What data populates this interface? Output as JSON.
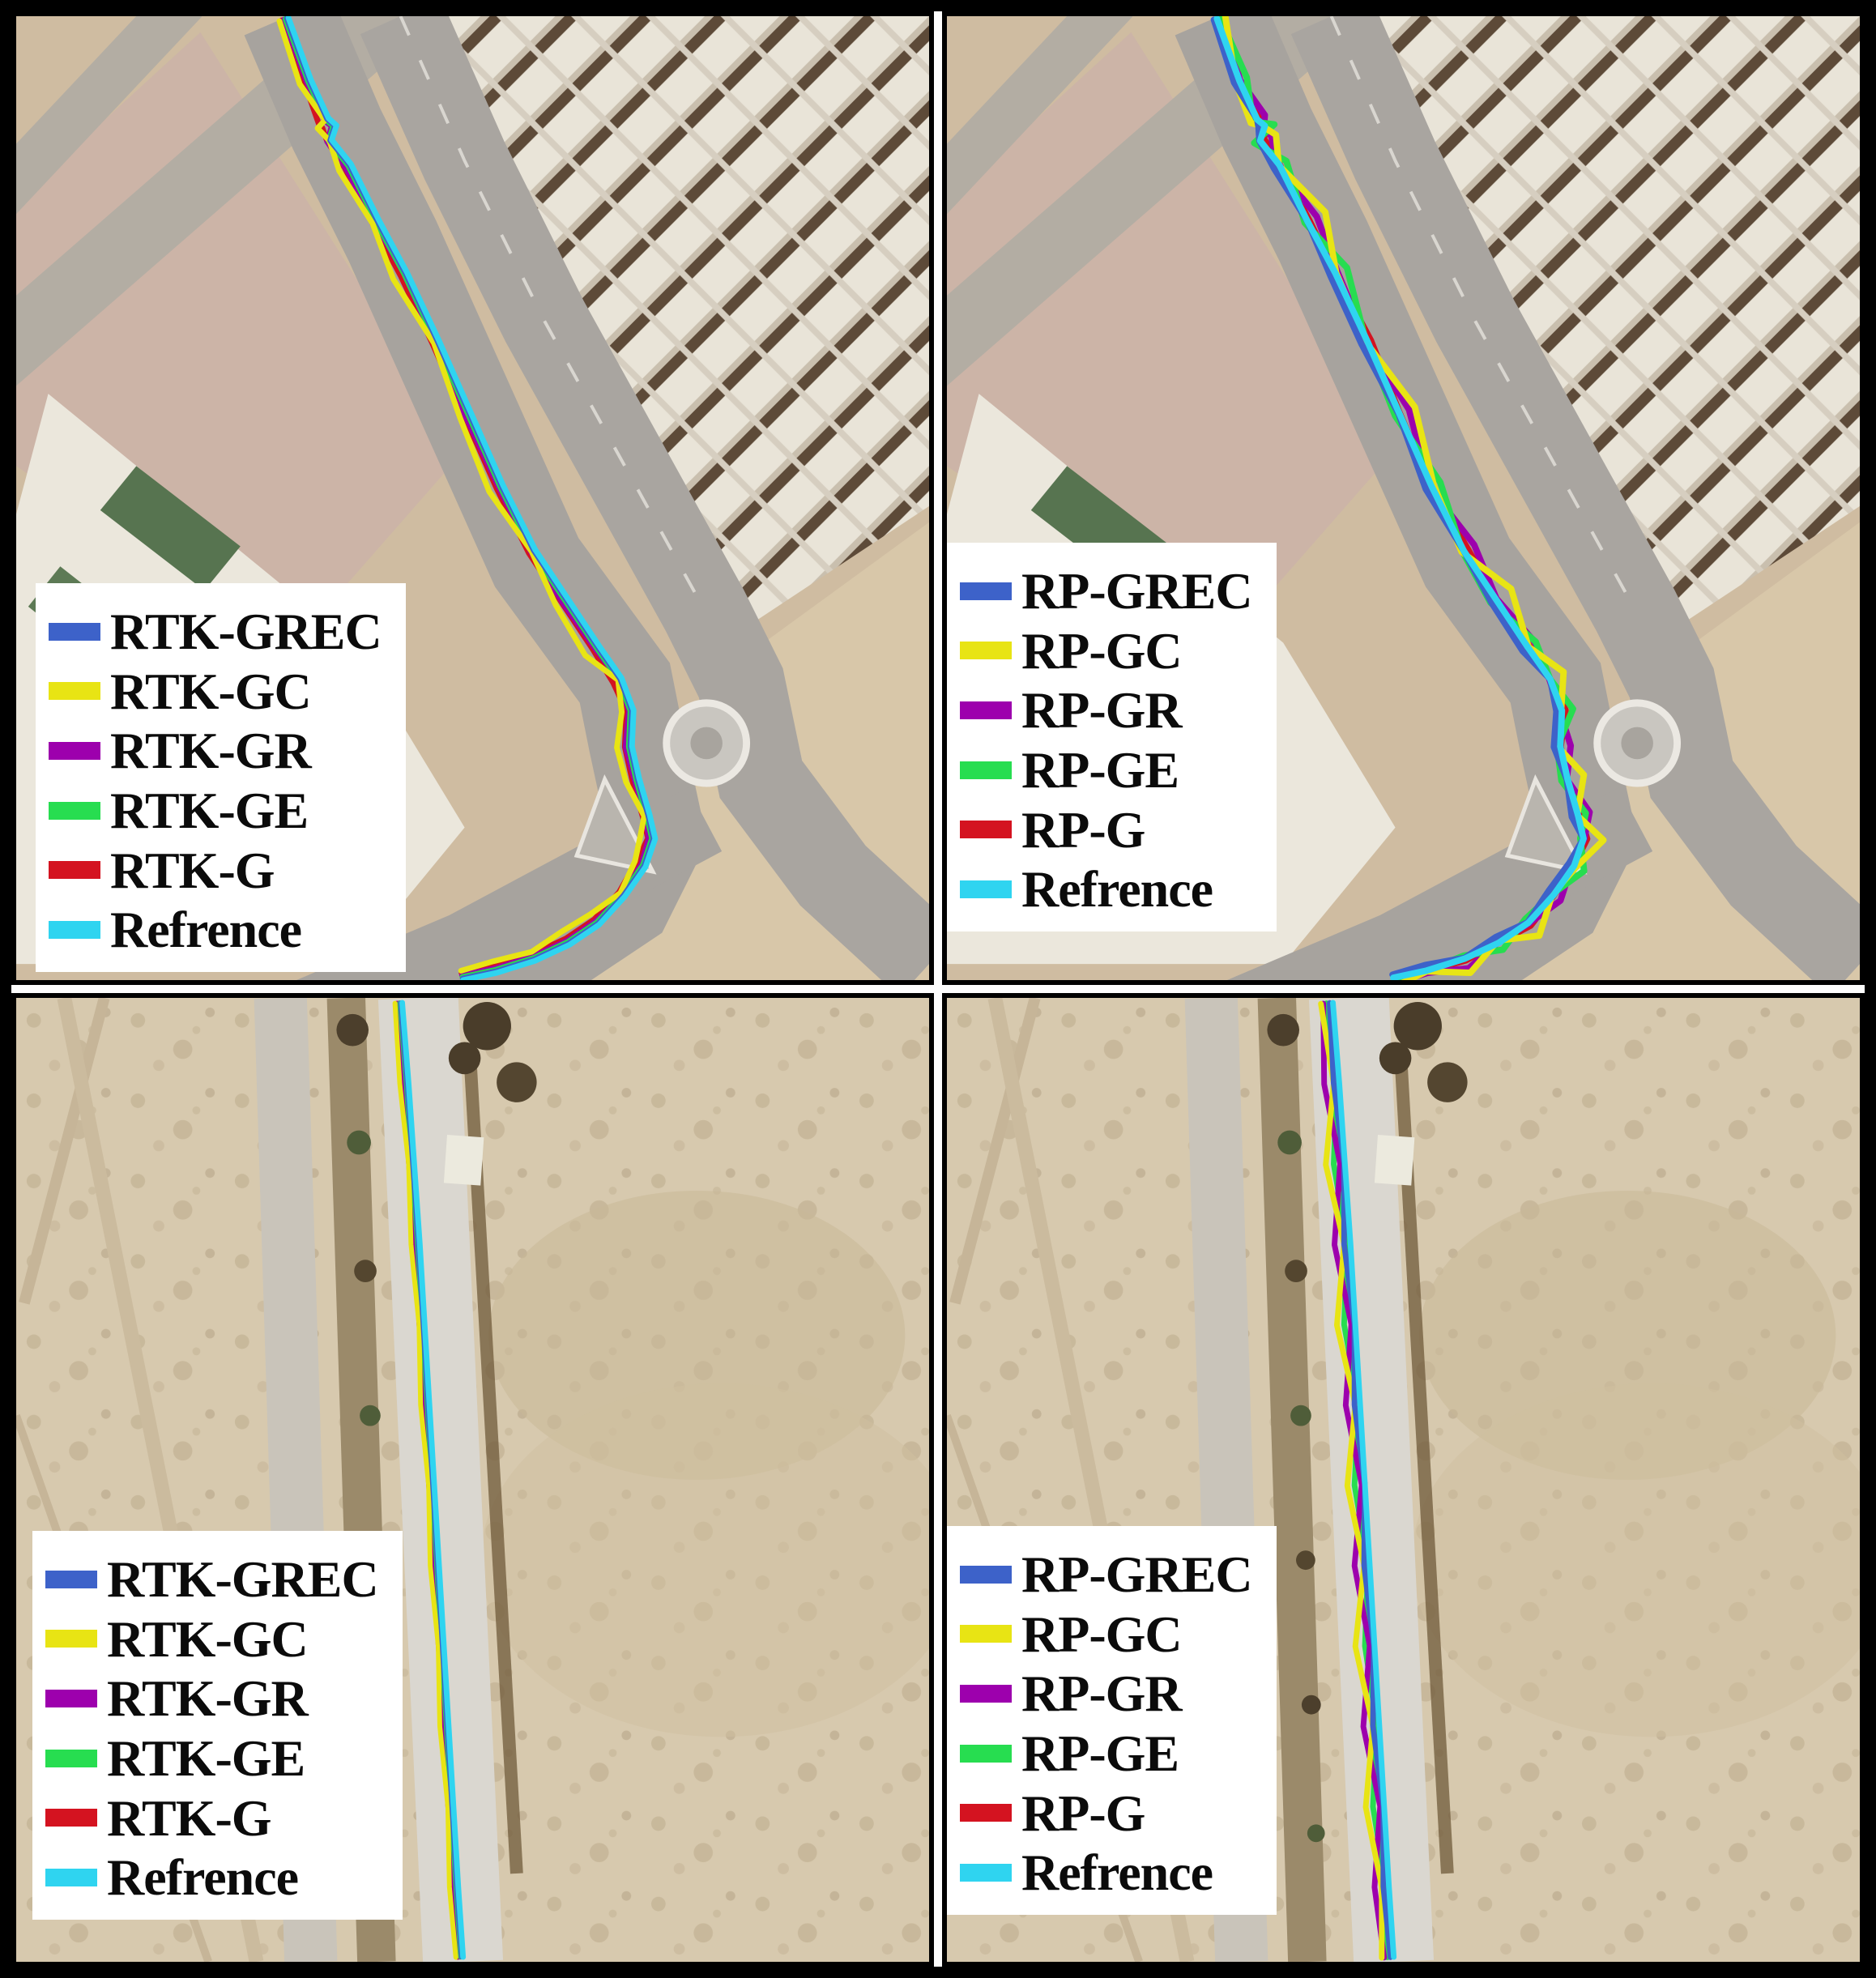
{
  "figure": {
    "kind": "satellite-trajectory-comparison",
    "rows": 2,
    "cols": 2
  },
  "colors": {
    "blue": "#3d62c9",
    "yellow": "#e8e414",
    "purple": "#9d00ad",
    "green": "#27dd50",
    "red": "#d41320",
    "cyan": "#2fd4f0"
  },
  "base_paths": {
    "diagonal": [
      [
        340,
        2
      ],
      [
        368,
        79
      ],
      [
        390,
        127
      ],
      [
        400,
        136
      ],
      [
        394,
        154
      ],
      [
        418,
        184
      ],
      [
        453,
        254
      ],
      [
        488,
        319
      ],
      [
        528,
        404
      ],
      [
        568,
        494
      ],
      [
        608,
        584
      ],
      [
        648,
        664
      ],
      [
        688,
        724
      ],
      [
        728,
        784
      ],
      [
        756,
        824
      ],
      [
        771,
        864
      ],
      [
        769,
        909
      ],
      [
        778,
        949
      ],
      [
        791,
        994
      ],
      [
        798,
        1024
      ],
      [
        786,
        1059
      ],
      [
        760,
        1096
      ],
      [
        728,
        1131
      ],
      [
        691,
        1156
      ],
      [
        648,
        1176
      ],
      [
        600,
        1191
      ],
      [
        558,
        1200
      ]
    ],
    "vertical": [
      [
        482,
        6
      ],
      [
        490,
        106
      ],
      [
        497,
        206
      ],
      [
        504,
        306
      ],
      [
        510,
        406
      ],
      [
        516,
        506
      ],
      [
        522,
        606
      ],
      [
        528,
        706
      ],
      [
        534,
        806
      ],
      [
        540,
        906
      ],
      [
        546,
        1006
      ],
      [
        552,
        1106
      ],
      [
        558,
        1194
      ]
    ]
  },
  "panels": [
    {
      "position": "top-left",
      "system": "RTK",
      "base_path": "diagonal",
      "legend": [
        {
          "label": "RTK-GREC",
          "color_key": "blue"
        },
        {
          "label": "RTK-GC",
          "color_key": "yellow"
        },
        {
          "label": "RTK-GR",
          "color_key": "purple"
        },
        {
          "label": "RTK-GE",
          "color_key": "green"
        },
        {
          "label": "RTK-G",
          "color_key": "red"
        },
        {
          "label": "Refrence",
          "color_key": "cyan"
        }
      ],
      "tracks": [
        {
          "label": "RTK-G",
          "color_key": "red",
          "offset": 9,
          "width": 7,
          "jitter": [
            0,
            0,
            5,
            9,
            -3,
            0,
            0,
            0,
            0,
            0,
            0,
            0,
            0,
            0,
            3,
            0,
            0,
            0,
            0,
            0,
            4,
            0,
            0,
            0,
            0,
            0,
            0
          ]
        },
        {
          "label": "RTK-GR",
          "color_key": "purple",
          "offset": 6,
          "width": 7,
          "jitter": [
            0,
            0,
            0,
            0,
            0,
            2,
            0,
            -2,
            0,
            2,
            0,
            0,
            2,
            0,
            -2,
            0,
            2,
            0,
            0,
            2,
            0,
            -2,
            0,
            0,
            0,
            0,
            0
          ]
        },
        {
          "label": "RTK-GE",
          "color_key": "green",
          "offset": 4,
          "width": 7,
          "jitter": [
            0,
            0,
            0,
            0,
            0,
            0,
            0,
            0,
            0,
            0,
            0,
            0,
            0,
            0,
            0,
            0,
            0,
            0,
            0,
            0,
            0,
            0,
            0,
            0,
            0,
            0,
            0
          ]
        },
        {
          "label": "RTK-GC",
          "color_key": "yellow",
          "offset": 12,
          "width": 7,
          "jitter": [
            0,
            3,
            -7,
            12,
            -9,
            5,
            -3,
            7,
            -5,
            3,
            7,
            -7,
            5,
            9,
            -7,
            3,
            7,
            5,
            -5,
            7,
            3,
            -5,
            5,
            7,
            0,
            3,
            0
          ]
        },
        {
          "label": "RTK-GREC",
          "color_key": "blue",
          "offset": 2,
          "width": 7,
          "jitter": [
            0,
            0,
            0,
            0,
            0,
            0,
            0,
            0,
            0,
            0,
            0,
            0,
            0,
            0,
            0,
            0,
            0,
            0,
            0,
            0,
            0,
            0,
            0,
            0,
            0,
            0,
            0
          ]
        },
        {
          "label": "Refrence",
          "color_key": "cyan",
          "offset": 0,
          "width": 7,
          "jitter": [
            0,
            0,
            0,
            0,
            0,
            0,
            0,
            0,
            0,
            0,
            0,
            0,
            0,
            0,
            0,
            0,
            0,
            0,
            0,
            0,
            0,
            0,
            0,
            0,
            0,
            0,
            0
          ]
        }
      ]
    },
    {
      "position": "top-right",
      "system": "RP",
      "base_path": "diagonal",
      "legend": [
        {
          "label": "RP-GREC",
          "color_key": "blue"
        },
        {
          "label": "RP-GC",
          "color_key": "yellow"
        },
        {
          "label": "RP-GR",
          "color_key": "purple"
        },
        {
          "label": "RP-GE",
          "color_key": "green"
        },
        {
          "label": "RP-G",
          "color_key": "red"
        },
        {
          "label": "Refrence",
          "color_key": "cyan"
        }
      ],
      "tracks": [
        {
          "label": "RP-G",
          "color_key": "red",
          "offset": 0,
          "width": 7,
          "jitter": [
            0,
            2,
            -2,
            3,
            -3,
            2,
            0,
            3,
            -2,
            2,
            3,
            -3,
            2,
            0,
            3,
            -2,
            2,
            3,
            0,
            -2,
            3,
            2,
            -2,
            3,
            0,
            2,
            0
          ]
        },
        {
          "label": "RP-GR",
          "color_key": "purple",
          "offset": -4,
          "width": 8,
          "jitter": [
            0,
            6,
            -4,
            8,
            -8,
            10,
            -6,
            4,
            8,
            -6,
            10,
            -8,
            6,
            -4,
            8,
            10,
            -6,
            8,
            -8,
            6,
            10,
            -4,
            6,
            8,
            -6,
            4,
            0
          ]
        },
        {
          "label": "RP-GE",
          "color_key": "green",
          "offset": -1,
          "width": 8,
          "jitter": [
            0,
            -6,
            10,
            -8,
            12,
            -6,
            8,
            -12,
            6,
            10,
            -8,
            6,
            12,
            -8,
            4,
            -10,
            8,
            12,
            -6,
            8,
            -10,
            6,
            10,
            -6,
            8,
            4,
            0
          ]
        },
        {
          "label": "RP-GC",
          "color_key": "yellow",
          "offset": -8,
          "width": 8,
          "jitter": [
            0,
            16,
            20,
            14,
            -10,
            12,
            -14,
            10,
            13,
            -10,
            8,
            14,
            -12,
            10,
            -8,
            12,
            14,
            -10,
            12,
            -14,
            8,
            13,
            -10,
            14,
            -8,
            10,
            0
          ]
        },
        {
          "label": "RP-GREC",
          "color_key": "blue",
          "offset": 7,
          "width": 8,
          "jitter": [
            0,
            3,
            -4,
            4,
            -3,
            4,
            -4,
            3,
            4,
            -3,
            4,
            -4,
            3,
            4,
            -4,
            3,
            4,
            -3,
            4,
            -4,
            3,
            4,
            -3,
            4,
            -3,
            3,
            0
          ]
        },
        {
          "label": "Refrence",
          "color_key": "cyan",
          "offset": 3,
          "width": 8,
          "jitter": [
            0,
            0,
            0,
            0,
            0,
            0,
            0,
            0,
            0,
            0,
            0,
            0,
            0,
            0,
            0,
            0,
            0,
            0,
            0,
            0,
            0,
            0,
            0,
            0,
            0,
            0,
            0
          ]
        }
      ]
    },
    {
      "position": "bottom-left",
      "system": "RTK",
      "base_path": "vertical",
      "legend": [
        {
          "label": "RTK-GREC",
          "color_key": "blue"
        },
        {
          "label": "RTK-GC",
          "color_key": "yellow"
        },
        {
          "label": "RTK-GR",
          "color_key": "purple"
        },
        {
          "label": "RTK-GE",
          "color_key": "green"
        },
        {
          "label": "RTK-G",
          "color_key": "red"
        },
        {
          "label": "Refrence",
          "color_key": "cyan"
        }
      ],
      "tracks": [
        {
          "label": "RTK-G",
          "color_key": "red",
          "offset": 7,
          "width": 6,
          "jitter": [
            0,
            0,
            0,
            0,
            0,
            0,
            0,
            0,
            0,
            0,
            0,
            0,
            0
          ]
        },
        {
          "label": "RTK-GR",
          "color_key": "purple",
          "offset": 5,
          "width": 6,
          "jitter": [
            0,
            0,
            0,
            0,
            0,
            0,
            0,
            0,
            0,
            0,
            0,
            0,
            0
          ]
        },
        {
          "label": "RTK-GE",
          "color_key": "green",
          "offset": 3,
          "width": 6,
          "jitter": [
            0,
            0,
            0,
            0,
            0,
            0,
            0,
            0,
            0,
            0,
            0,
            0,
            0
          ]
        },
        {
          "label": "RTK-GC",
          "color_key": "yellow",
          "offset": 9,
          "width": 6,
          "jitter": [
            0,
            2,
            -2,
            2,
            -2,
            2,
            -2,
            2,
            -2,
            2,
            -2,
            2,
            0
          ]
        },
        {
          "label": "RTK-GREC",
          "color_key": "blue",
          "offset": 2,
          "width": 6,
          "jitter": [
            0,
            0,
            0,
            0,
            0,
            0,
            0,
            0,
            0,
            0,
            0,
            0,
            0
          ]
        },
        {
          "label": "Refrence",
          "color_key": "cyan",
          "offset": 0,
          "width": 7,
          "jitter": [
            0,
            0,
            0,
            0,
            0,
            0,
            0,
            0,
            0,
            0,
            0,
            0,
            0
          ]
        }
      ]
    },
    {
      "position": "bottom-right",
      "system": "RP",
      "base_path": "vertical",
      "legend": [
        {
          "label": "RP-GREC",
          "color_key": "blue"
        },
        {
          "label": "RP-GC",
          "color_key": "yellow"
        },
        {
          "label": "RP-GR",
          "color_key": "purple"
        },
        {
          "label": "RP-GE",
          "color_key": "green"
        },
        {
          "label": "RP-G",
          "color_key": "red"
        },
        {
          "label": "Refrence",
          "color_key": "cyan"
        }
      ],
      "tracks": [
        {
          "label": "RP-G",
          "color_key": "red",
          "offset": 5,
          "width": 6,
          "jitter": [
            0,
            2,
            -2,
            2,
            -2,
            2,
            -2,
            2,
            -2,
            2,
            -2,
            2,
            0
          ]
        },
        {
          "label": "RP-GE",
          "color_key": "green",
          "offset": 8,
          "width": 7,
          "jitter": [
            0,
            -5,
            6,
            -4,
            6,
            -6,
            5,
            -6,
            4,
            -5,
            6,
            -4,
            0
          ]
        },
        {
          "label": "RP-GR",
          "color_key": "purple",
          "offset": 12,
          "width": 7,
          "jitter": [
            0,
            7,
            -6,
            8,
            -7,
            6,
            -8,
            7,
            -6,
            8,
            -7,
            6,
            0
          ]
        },
        {
          "label": "RP-GC",
          "color_key": "yellow",
          "offset": 15,
          "width": 7,
          "jitter": [
            0,
            -8,
            9,
            -7,
            8,
            -9,
            7,
            -8,
            9,
            -7,
            8,
            -6,
            0
          ]
        },
        {
          "label": "RP-GREC",
          "color_key": "blue",
          "offset": 4,
          "width": 7,
          "jitter": [
            0,
            3,
            -3,
            4,
            -3,
            3,
            -4,
            3,
            -3,
            4,
            -3,
            3,
            0
          ]
        },
        {
          "label": "Refrence",
          "color_key": "cyan",
          "offset": 0,
          "width": 7,
          "jitter": [
            0,
            0,
            0,
            0,
            0,
            0,
            0,
            0,
            0,
            0,
            0,
            0,
            0
          ]
        }
      ]
    }
  ]
}
